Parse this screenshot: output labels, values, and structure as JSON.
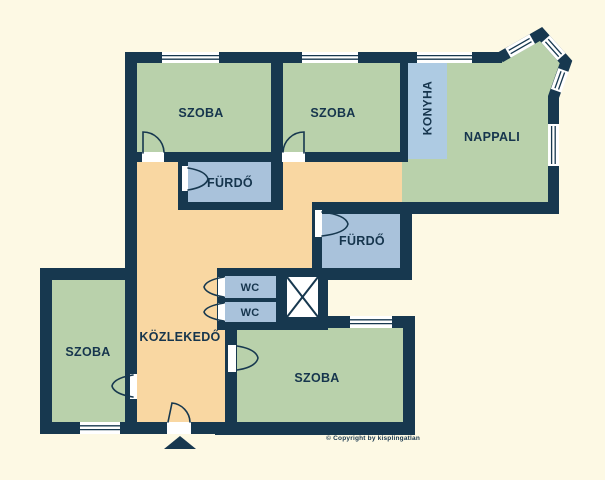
{
  "plan": {
    "colors": {
      "background": "#fdf9e4",
      "wall": "#17384f",
      "room_green": "#b9d1ab",
      "room_blue": "#a9c2db",
      "kitchen_blue": "#aecbe3",
      "hall_orange": "#f9d7a2",
      "window_white": "#ffffff",
      "label": "#16354d"
    },
    "labels": {
      "szoba": "SZOBA",
      "konyha": "KONYHA",
      "nappali": "NAPPALI",
      "furdo": "FÜRDŐ",
      "wc": "WC",
      "kozlekedo": "KÖZLEKEDŐ"
    },
    "copyright": "© Copyright by kisplingatlan"
  }
}
